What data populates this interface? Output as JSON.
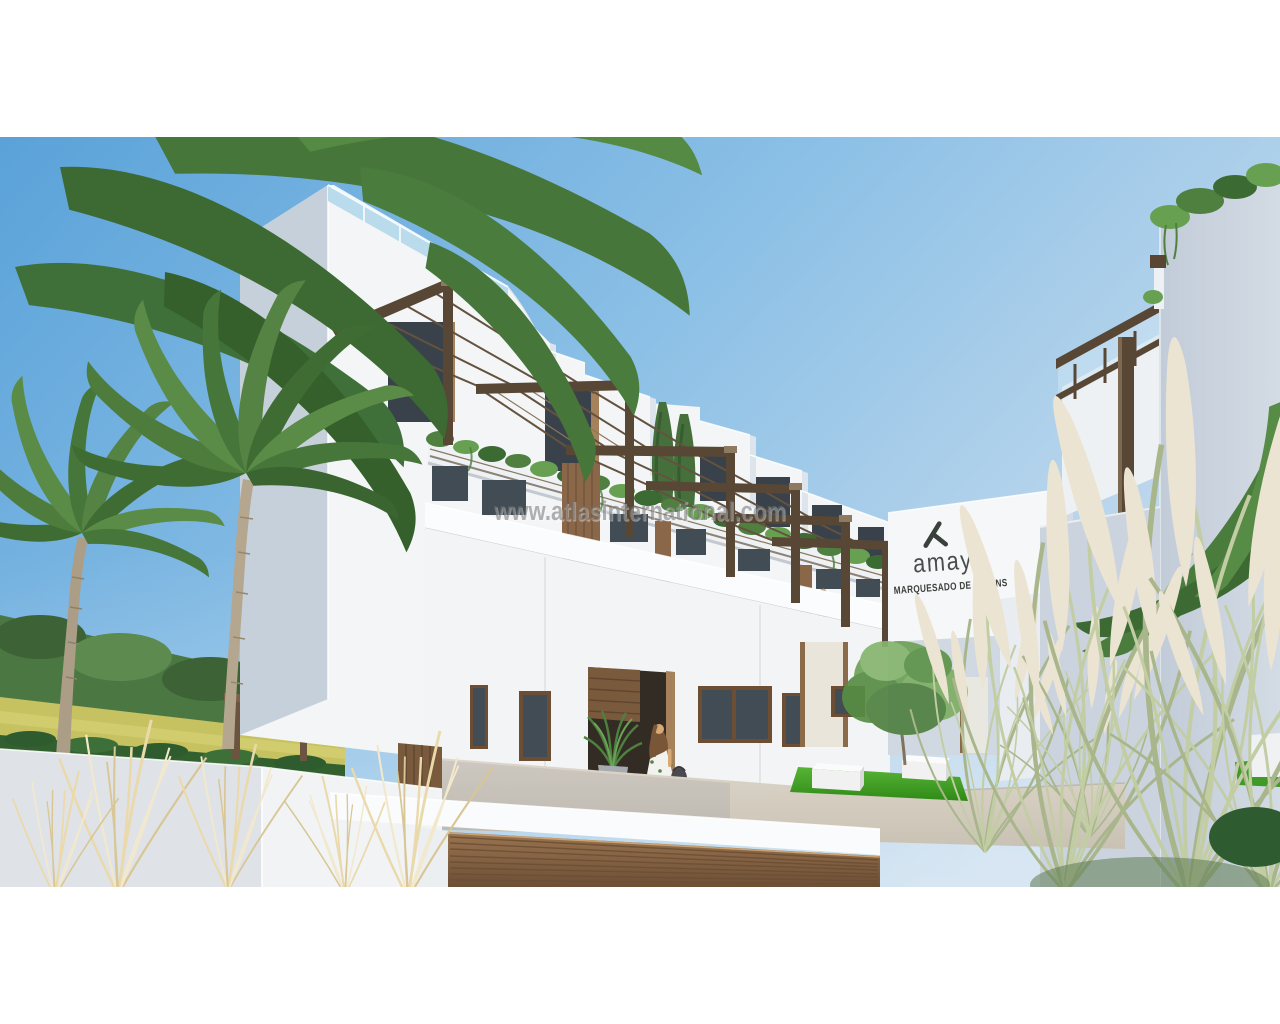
{
  "watermark": {
    "text": "www.atlasinternational.com"
  },
  "sign": {
    "brand": "amay",
    "development": "MARQUESADO DE MOLINS",
    "text_color": "#474d48"
  },
  "palette": {
    "sky_top": "#5aa2d9",
    "sky_light": "#c9ddee",
    "wall_sunlit_white": "#f3f5f7",
    "wall_shaded": "#c6d0db",
    "right_wall_shaded": "#c8d1dc",
    "pergola_bronze": "#584734",
    "wood_cladding": "#8a6748",
    "plant_green": "#4f8040",
    "lawn_green": "#2e8a16",
    "pampas_cream": "#ece4d2",
    "field_yellow": "#c6c161",
    "watermark_gray": "#787878"
  }
}
